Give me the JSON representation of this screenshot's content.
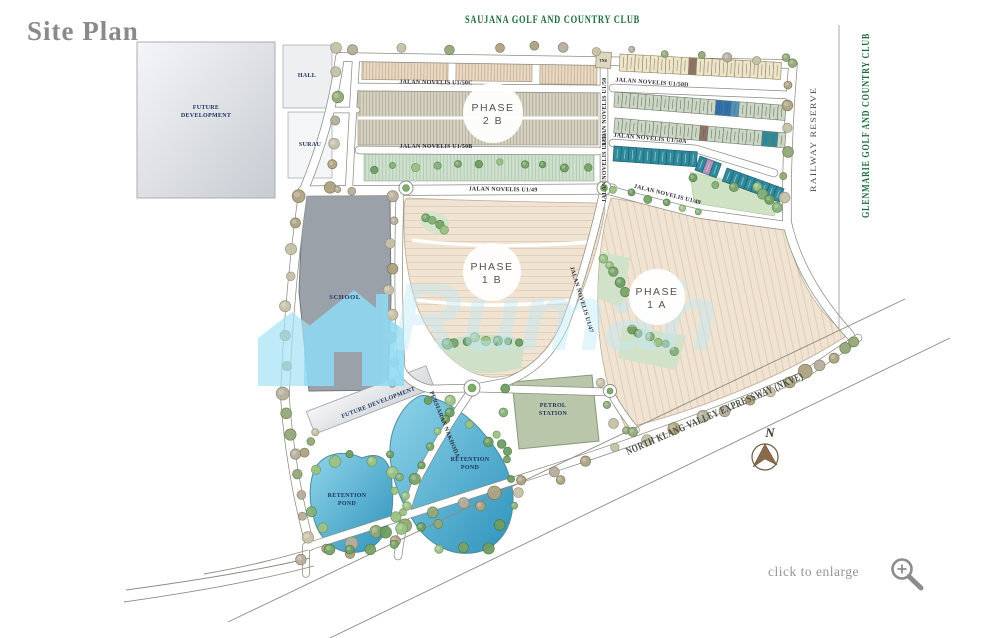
{
  "page": {
    "title": "Site Plan",
    "enlarge_hint": "click to enlarge"
  },
  "surroundings": {
    "top_label": "SAUJANA GOLF AND COUNTRY CLUB",
    "glenmarie": "GLENMARIE GOLF AND COUNTRY CLUB",
    "railway": "RAILWAY RESERVE",
    "expressway": "NORTH KLANG VALLEY EXPRESSWAY (NKVE)"
  },
  "compass": {
    "north": "N"
  },
  "watermark": {
    "text": "Rumah"
  },
  "areas": {
    "future_line1": "FUTURE",
    "future_line2": "DEVELOPMENT",
    "future_full": "FUTURE DEVELOPMENT",
    "hall": "HALL",
    "surau": "SURAU",
    "tnb": "TNB",
    "school": "SCHOOL",
    "petrol_line1": "PETROL",
    "petrol_line2": "STATION",
    "retention_line1": "RETENTION",
    "retention_line2": "POND",
    "phase_word": "PHASE",
    "phase_2b": "2 B",
    "phase_1b": "1 B",
    "phase_1a": "1 A"
  },
  "streets": {
    "u150c": "JALAN NOVELIS U1/50C",
    "u150b": "JALAN NOVELIS U1/50B",
    "u150d": "JALAN NOVELIS U1/50D",
    "u150a": "JALAN NOVELIS U1/50A",
    "u150": "JALAN NOVELIS U1/50",
    "u149": "JALAN NOVELIS U1/49",
    "u147": "JALAN NOVELIS U1/47",
    "nakhoda": "PERSIARAN NAKHODA"
  },
  "colors": {
    "accent_teal": "#2f8a9c",
    "accent_blue": "#2d6fb0",
    "accent_blue_light": "#4e93c0",
    "accent_purple": "#b292bd",
    "accent_brown": "#8d7365",
    "lot_cream": "#eee4c9",
    "lot_sage": "#ccd6c5",
    "pond_blue": "#3da3c8",
    "petrol_green": "#b9c6a9",
    "school_gray": "#9aa1a9",
    "future_gray": "#dfe2e6",
    "header_green": "#1e6b3f",
    "title_gray": "#8b8b8b",
    "label_navy": "#1f3460",
    "watermark_blue": "#8ed9f2"
  }
}
